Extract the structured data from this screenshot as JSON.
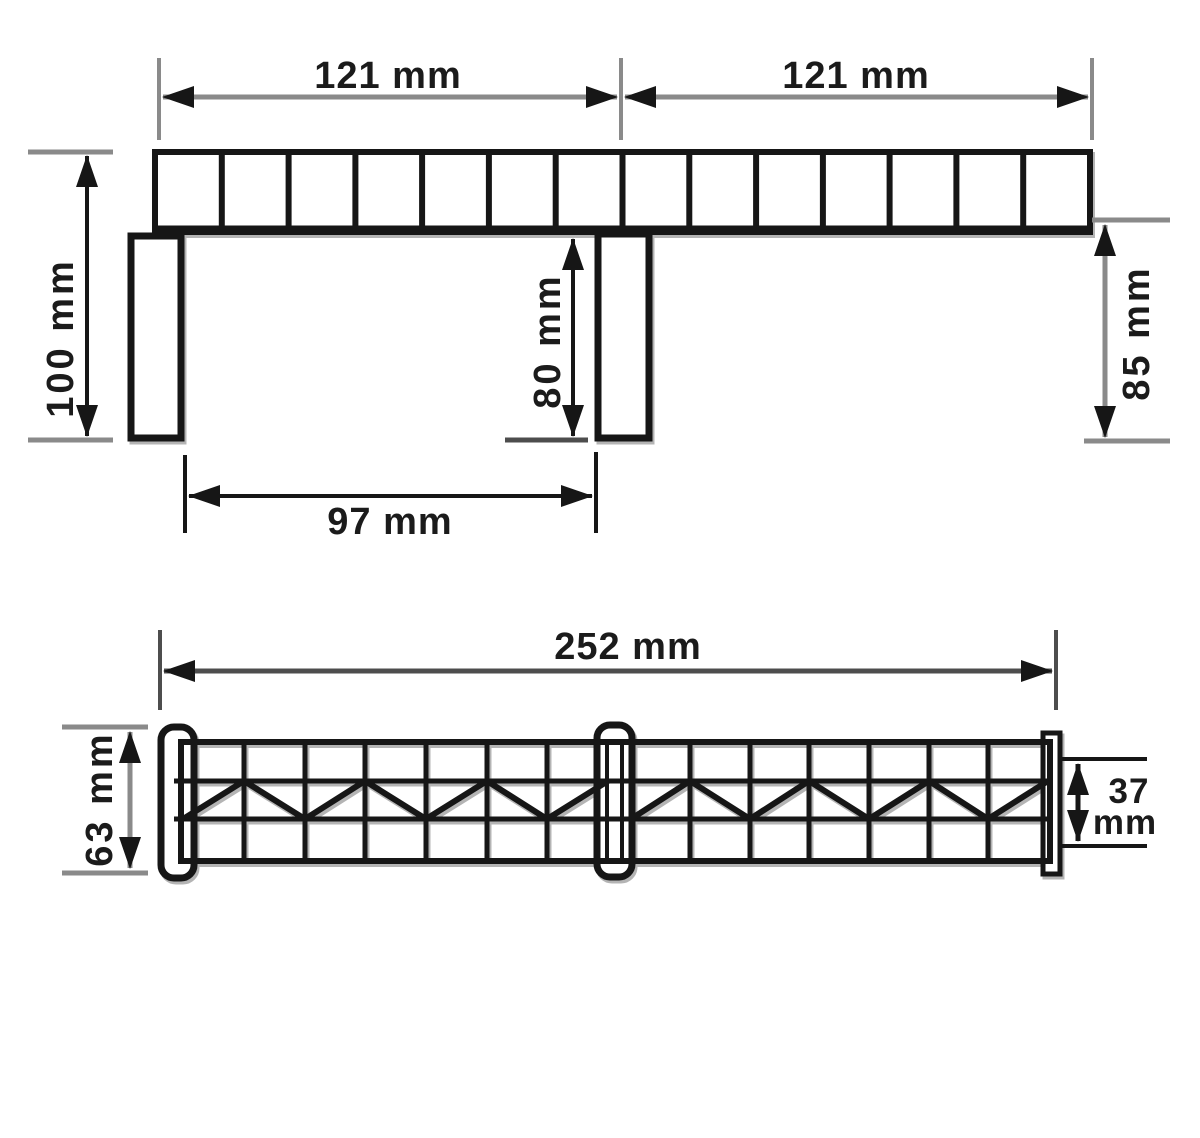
{
  "drawing": {
    "type": "dimensioned technical drawing",
    "views": [
      "front elevation with piers",
      "side truss elevation"
    ]
  },
  "dims_top": {
    "span_left": "121 mm",
    "span_right": "121 mm",
    "height_overall": "100 mm",
    "pier_height": "80 mm",
    "height_right": "85 mm",
    "pier_spacing": "97 mm"
  },
  "dims_side": {
    "length_overall": "252 mm",
    "height_overall": "63 mm",
    "girder_height_value": "37",
    "girder_height_unit": "mm"
  },
  "values_mm": {
    "span_left": 121,
    "span_right": 121,
    "overall_height": 100,
    "pier_height": 80,
    "right_height": 85,
    "pier_spacing": 97,
    "overall_length": 252,
    "side_height": 63,
    "girder_height": 37
  },
  "structure": {
    "deck_segments": 14,
    "piers": 2,
    "end_posts": 2,
    "truss_panels_per_half": 7
  },
  "colors": {
    "ink": "#161616",
    "dim_gray": "#8a8a8a",
    "dim_dark_gray": "#4d4d4d",
    "background": "#ffffff"
  }
}
